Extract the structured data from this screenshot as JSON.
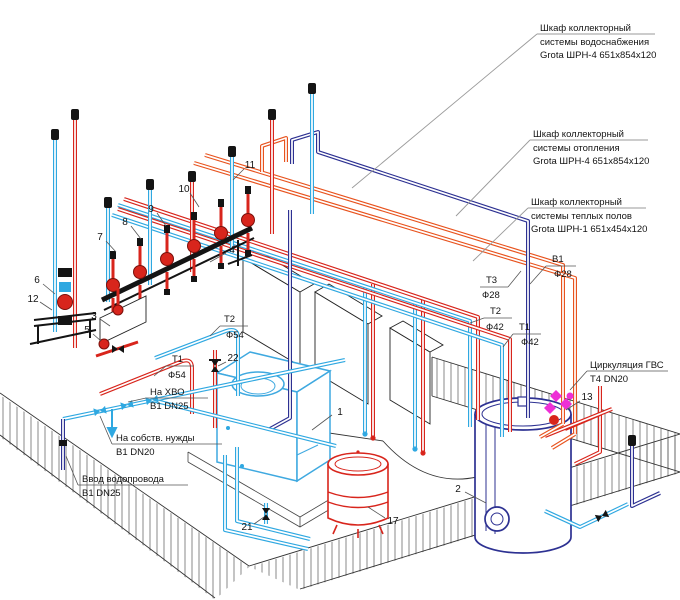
{
  "labels": {
    "cab_water": {
      "l1": "Шкаф коллекторный",
      "l2": "системы водоснабжения",
      "l3": "Grota ШРН-4 651x854x120"
    },
    "cab_heating": {
      "l1": "Шкаф коллекторный",
      "l2": "системы отопления",
      "l3": "Grota ШРН-4 651x854x120"
    },
    "cab_floor": {
      "l1": "Шкаф коллекторный",
      "l2": "системы теплых полов",
      "l3": "Grota ШРН-1 651x454x120"
    },
    "gvs": {
      "l1": "Циркуляция ГВС",
      "l2": "Т4 DN20"
    },
    "xvo": {
      "l1": "На ХВО",
      "l2": "В1 DN25"
    },
    "own_needs": {
      "l1": "На собств. нужды",
      "l2": "В1 DN20"
    },
    "water_inlet": {
      "l1": "Ввод водопровода",
      "l2": "В1 DN25"
    }
  },
  "pipe_tags": {
    "b1": {
      "name": "В1",
      "dia": "Ф28"
    },
    "t3": {
      "name": "Т3",
      "dia": "Ф28"
    },
    "t2_42": {
      "name": "Т2",
      "dia": "Ф42"
    },
    "t1_42": {
      "name": "Т1",
      "dia": "Ф42"
    },
    "t2_54": {
      "name": "Т2",
      "dia": "Ф54"
    },
    "t1_54": {
      "name": "Т1",
      "dia": "Ф54"
    }
  },
  "item_numbers": {
    "n1": "1",
    "n2": "2",
    "n3": "3",
    "n4": "4",
    "n5": "5",
    "n6": "6",
    "n7": "7",
    "n8": "8",
    "n9": "9",
    "n10": "10",
    "n11": "11",
    "n12": "12",
    "n13": "13",
    "n17": "17",
    "n21": "21",
    "n22": "22"
  },
  "colors": {
    "pipe_red": "#d8251c",
    "pipe_blue": "#2fa8e1",
    "pipe_navy": "#2d3192",
    "pipe_orange": "#e8531e",
    "valve_magenta": "#ee2fd6",
    "leader_grey": "#9a9a9a"
  }
}
